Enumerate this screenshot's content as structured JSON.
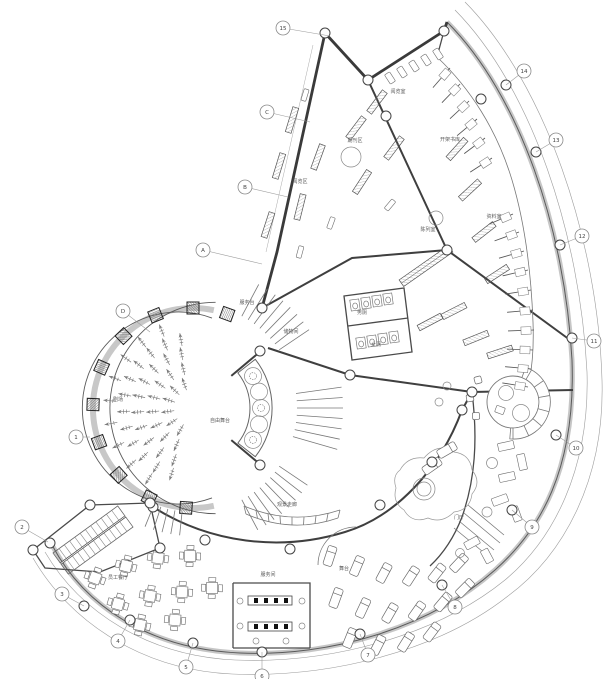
{
  "drawing": {
    "type": "architectural-floor-plan",
    "rooms": {
      "theater": "剧场",
      "free_stage": "自由舞台",
      "service_desk": "服务台",
      "storage": "储物间",
      "reading_area": "阅览区",
      "periodicals": "期刊区",
      "reading_room": "阅览室",
      "open_stacks": "开架书库",
      "reference_room": "资料室",
      "display_room": "陈列室",
      "toilet_m": "男厕",
      "toilet_f": "女厕",
      "gallery": "观景走廊",
      "staff_dining": "员工餐厅",
      "service_room": "服务间",
      "small_stage": "舞台",
      "entry_hall": "门厅"
    },
    "grid_bubbles": [
      "15",
      "C",
      "B",
      "A",
      "D",
      "1",
      "2",
      "3",
      "4",
      "5",
      "6",
      "7",
      "8",
      "9",
      "10",
      "11",
      "12",
      "13",
      "14"
    ],
    "colors": {
      "wall": "#3a3a3a",
      "ring": "#c8c8c8",
      "dimension_line": "#9c9c9c",
      "text": "#5a5a5a",
      "paper": "#ffffff"
    }
  }
}
